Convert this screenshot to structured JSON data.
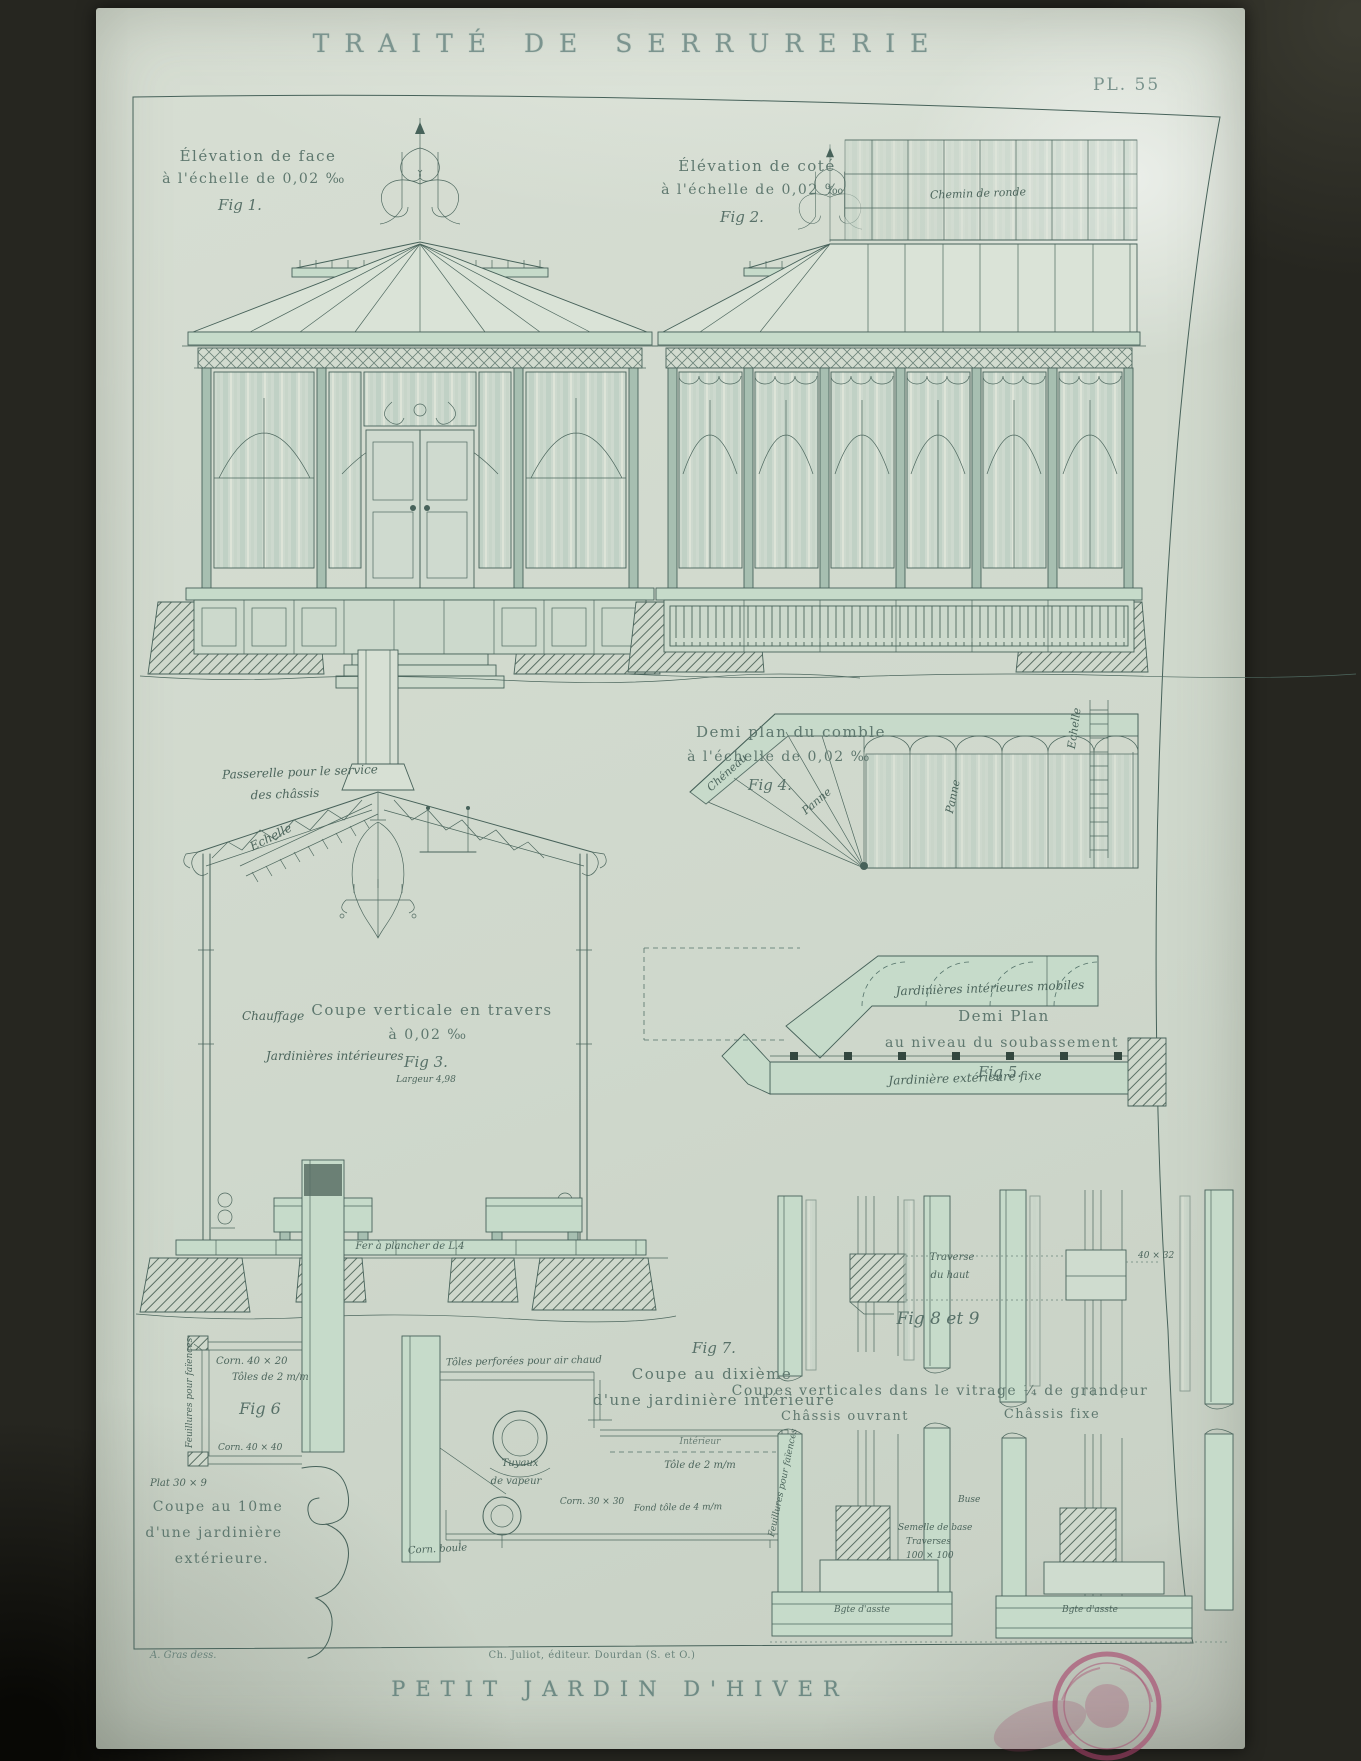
{
  "colors": {
    "paper": "#d3dbd0",
    "ink": "#47625a",
    "wash": "#c6dbca",
    "glass": "#cdd9ce",
    "stamp": "#a64069"
  },
  "plate": {
    "title": "TRAITÉ DE SERRURERIE",
    "number": "PL. 55",
    "bottom_title": "PETIT JARDIN D'HIVER",
    "credit": "A. Gras dess.",
    "publisher": "Ch. Juliot, éditeur. Dourdan (S. et O.)"
  },
  "fig1": {
    "caption1": "Élévation de face",
    "caption2": "à l'échelle de 0,02 ‰",
    "label": "Fig 1."
  },
  "fig2": {
    "caption1": "Élévation de coté",
    "caption2": "à l'échelle de 0,02 ‰",
    "label": "Fig 2.",
    "roof_note": "Chemin de ronde"
  },
  "fig3": {
    "caption1": "Coupe verticale en travers",
    "caption2": "à 0,02 ‰",
    "label": "Fig 3.",
    "width_note": "Largeur 4,98",
    "passerelle1": "Passerelle pour le service",
    "passerelle2": "des châssis",
    "echelle": "Echelle",
    "chauffage": "Chauffage",
    "jardinieres": "Jardinières intérieures",
    "plancher": "Fer à plancher de L.4"
  },
  "fig4": {
    "caption1": "Demi plan du comble",
    "caption2": "à l'échelle de 0,02 ‰",
    "label": "Fig 4.",
    "cheneau": "Chéneau",
    "panne1": "Panne",
    "panne2": "Panne",
    "echelle": "Echelle"
  },
  "fig5": {
    "caption1": "Demi Plan",
    "caption2": "au niveau du soubassement",
    "label": "Fig 5.",
    "mobiles": "Jardinières intérieures mobiles",
    "fixe": "Jardinière extérieure fixe"
  },
  "fig6": {
    "label": "Fig 6",
    "caption1": "Coupe au 10me",
    "caption2": "d'une jardinière",
    "caption3": "extérieure.",
    "corn_haut": "Corn. 40 × 20",
    "toles": "Tôles de 2 m/m",
    "feuillures": "Feuillures pour faïences",
    "corn_bas": "Corn. 40 × 40",
    "plat": "Plat 30 × 9"
  },
  "fig7": {
    "label": "Fig 7.",
    "caption1": "Coupe au dixième",
    "caption2": "d'une jardinière intérieure",
    "toles_perforees": "Tôles perforées pour air chaud",
    "tuyaux1": "Tuyaux",
    "tuyaux2": "de vapeur",
    "interieur": "Intérieur",
    "tole": "Tôle de 2 m/m",
    "corn": "Corn. 30 × 30",
    "fond": "Fond tôle de 4 m/m",
    "feuillures": "Feuillures pour faïences",
    "boule": "Corn. boule"
  },
  "fig89": {
    "label": "Fig 8 et 9",
    "traverse1": "Traverse",
    "traverse2": "du haut",
    "dim": "40 × 32",
    "caption": "Coupes verticales dans le vitrage ¼ de grandeur",
    "left": "Châssis ouvrant",
    "right": "Châssis fixe",
    "buse": "Buse",
    "semelle1": "Semelle de base",
    "semelle2": "Traverses",
    "semelle3": "100 × 100",
    "bgte_left": "Bgte d'asste",
    "bgte_right": "Bgte d'asste"
  }
}
